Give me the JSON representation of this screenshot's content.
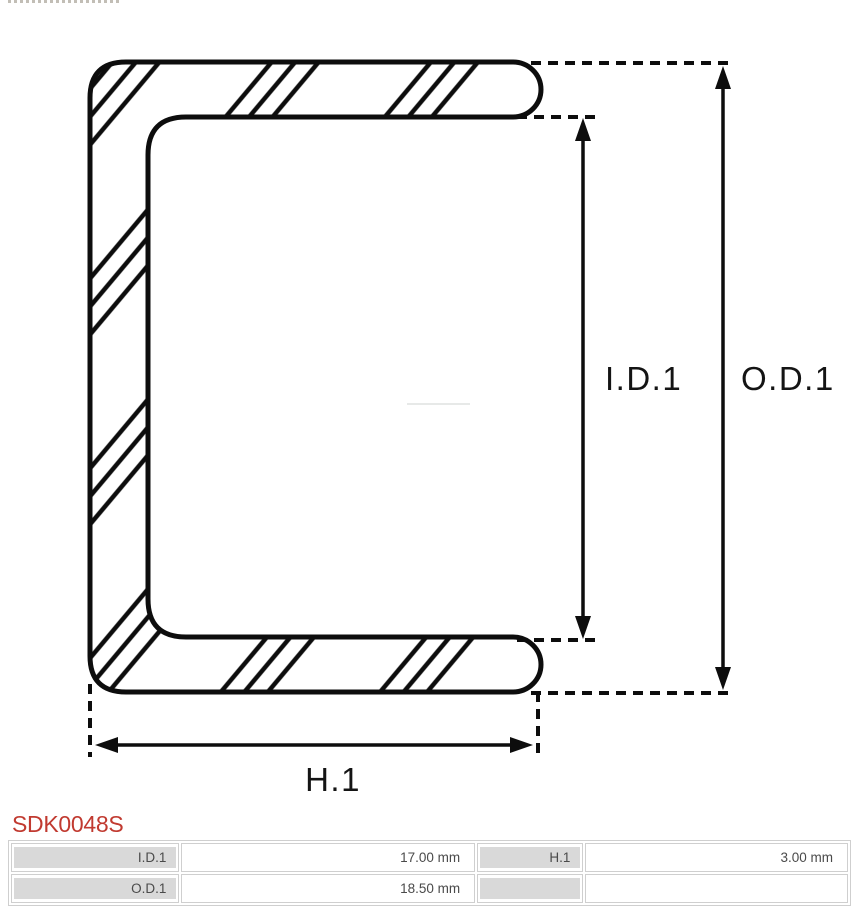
{
  "part_number": "SDK0048S",
  "drawing": {
    "labels": {
      "inner_diameter": "I.D.1",
      "outer_diameter": "O.D.1",
      "height": "H.1"
    }
  },
  "table": {
    "rows": [
      {
        "cells": [
          {
            "text": "I.D.1"
          },
          {
            "text": "17.00 mm"
          },
          {
            "text": "H.1"
          },
          {
            "text": "3.00 mm"
          }
        ]
      },
      {
        "cells": [
          {
            "text": "O.D.1"
          },
          {
            "text": "18.50 mm"
          },
          {
            "text": ""
          },
          {
            "text": ""
          }
        ]
      }
    ]
  },
  "colors": {
    "line_black": "#0d0d0d",
    "part_number_red": "#c13a30",
    "cell_grey": "#d9d9d9",
    "border_grey": "#cfcfcf",
    "text_grey": "#4a4a4a"
  }
}
